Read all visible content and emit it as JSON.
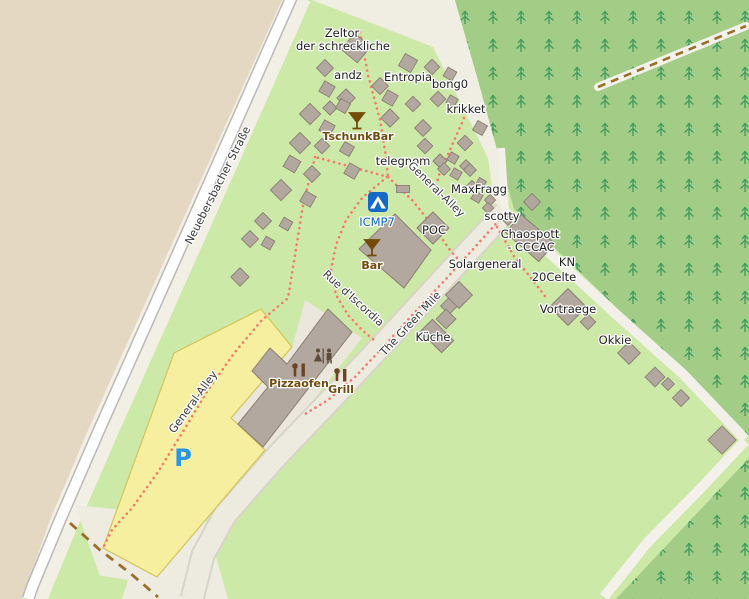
{
  "app": {
    "type": "web-map",
    "description": "OpenStreetMap-style rendering of a hacker-camp site"
  },
  "map": {
    "labels": {
      "zeltor_line1": "Zeltor",
      "zeltor_line2": "der schreckliche",
      "andz": "andz",
      "entropia": "Entropia",
      "bong0": "bong0",
      "krikket": "krikket",
      "tschunkbar": "TschunkBar",
      "telegnom": "telegnom",
      "general_alley": "General-Alley",
      "maxfragg": "MaxFragg",
      "scotty": "scotty",
      "icmp7": "ICMP7",
      "poc": "POC",
      "chaospott_line1": "Chaospott",
      "chaospott_line2": "- CCCAC",
      "bar": "Bar",
      "solargeneral": "Solargeneral",
      "kn": "KN",
      "celte20": "20Celte",
      "vortraege": "Vortraege",
      "okkie": "Okkie",
      "kueche": "Küche",
      "rue_discordia": "Rue d'Iscordia",
      "green_mile": "The Green Mile",
      "general_alley_parking": "General-Alley",
      "pizzaofen": "Pizzaofen",
      "grill": "Grill",
      "strasse": "Neuebersbacher Straße",
      "parking_symbol": "P"
    },
    "icons": {
      "campsite": "tent-icon",
      "tschunkbar": "cocktail-icon",
      "bar": "cocktail-icon",
      "toilets": "toilets-icon",
      "pizzaofen": "food-stall-icon",
      "grill": "food-stall-icon",
      "parking": "parking-symbol",
      "forest": "conifer-tree-icon"
    },
    "colors": {
      "grass": "#cde9a7",
      "forest": "#a3cc86",
      "forest_dark": "#8dc46e",
      "tree": "#3f9a5c",
      "farmland_tan": "#e4d8c2",
      "ground_beige": "#f2efe5",
      "plaza": "#ebe7dc",
      "road_fill": "#ffffff",
      "road_casing": "#b9b9b9",
      "pedestrian_road": "#edeae0",
      "parking_fill": "#f6ef9f",
      "parking_border": "#d2c45c",
      "building_fill": "#b3a89f",
      "building_border": "#897e72",
      "footpath_red": "#f8786b",
      "track_brown": "#9d6e28",
      "poi_label_brown": "#734a08",
      "tourism_label_blue": "#0b62cc",
      "parking_blue": "#2795e9",
      "campsite_icon_blue": "#1569c9"
    }
  }
}
